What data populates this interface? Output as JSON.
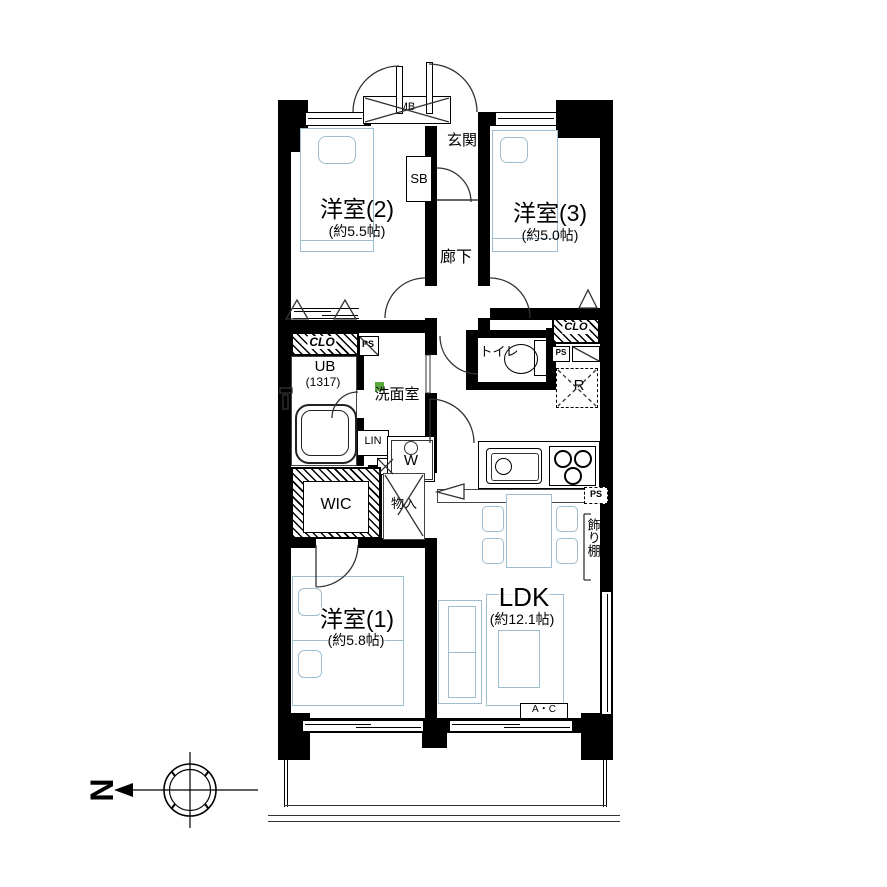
{
  "labels": {
    "entrance": "玄関",
    "shoe_box": "SB",
    "meter_box": "MB",
    "hallway": "廊下",
    "room2_name": "洋室(2)",
    "room2_size": "(約5.5帖)",
    "room3_name": "洋室(3)",
    "room3_size": "(約5.0帖)",
    "room1_name": "洋室(1)",
    "room1_size": "(約5.8帖)",
    "ldk_name": "LDK",
    "ldk_size": "(約12.1帖)",
    "closet_left": "CLO",
    "closet_right": "CLO",
    "pipe_space_left": "PS",
    "pipe_space_right": "PS",
    "pipe_space_kitchen": "PS",
    "unit_bath": "UB",
    "unit_bath_size": "(1317)",
    "washroom": "洗面室",
    "linen": "LIN",
    "washer": "W",
    "toilet": "トイレ",
    "fridge": "R",
    "wic": "WIC",
    "storage": "物入",
    "shelf": "飾り棚",
    "aircon": "A・C",
    "compass_north": "N"
  },
  "colors": {
    "wall": "#000000",
    "furniture_outline": "#9fbdd1",
    "washer_marker_green": "#5ba83e",
    "line": "#333333"
  }
}
